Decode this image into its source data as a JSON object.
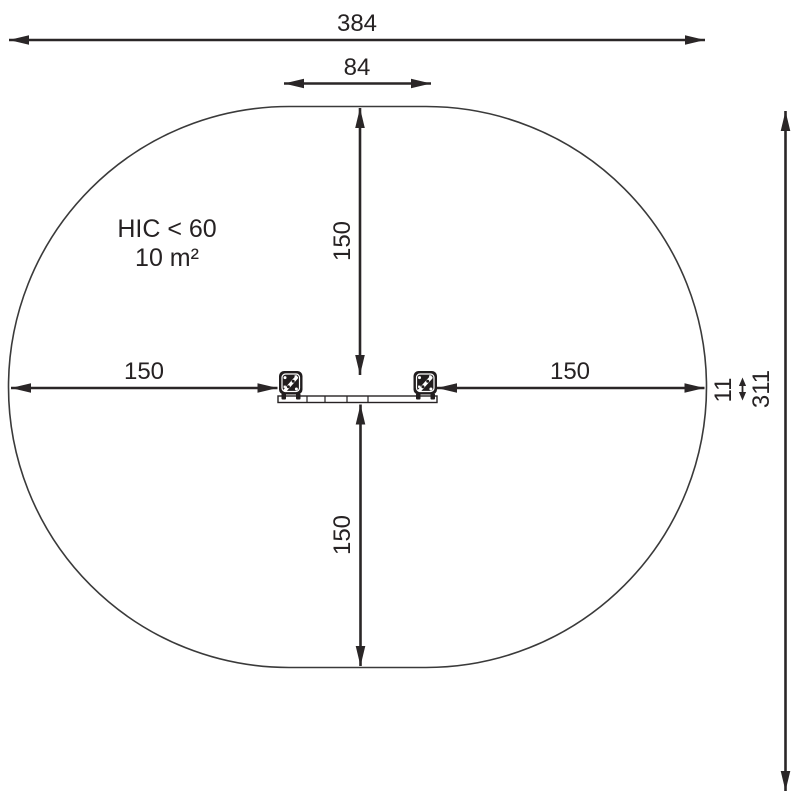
{
  "note": {
    "line1": "HIC < 60",
    "line2": "10 m²"
  },
  "dimensions": {
    "overall_width": "384",
    "equipment_width": "84",
    "clearance_top": "150",
    "clearance_bottom": "150",
    "clearance_left": "150",
    "clearance_right": "150",
    "beam_depth": "11",
    "overall_depth": "311"
  },
  "equipment": {
    "left_post_icon": "post-top-view",
    "right_post_icon": "post-top-view",
    "beam": "balance-beam-top-view"
  },
  "colors": {
    "line": "#2a2627",
    "outline": "#3a3a3a",
    "background": "#ffffff"
  }
}
